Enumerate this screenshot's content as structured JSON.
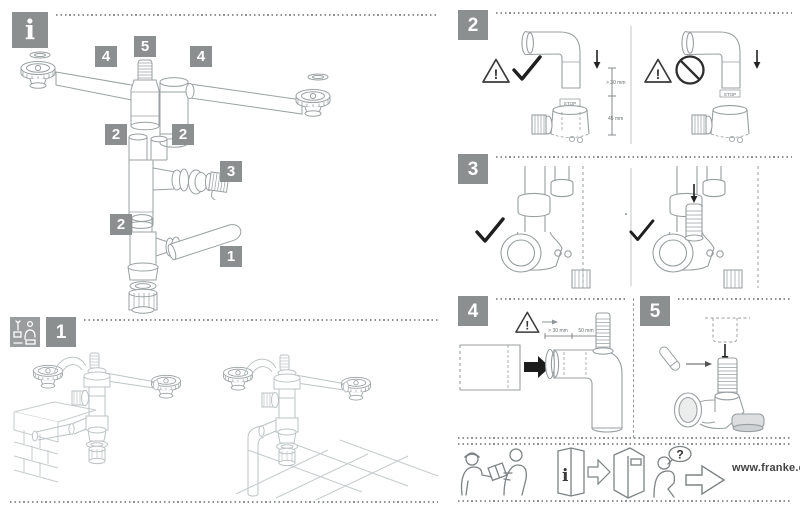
{
  "info_panel": {
    "icon": "i",
    "part_labels": [
      "4",
      "5",
      "4",
      "2",
      "2",
      "3",
      "2",
      "1"
    ]
  },
  "steps": [
    {
      "number": "1"
    },
    {
      "number": "2",
      "dim_upper": "> 30 mm",
      "dim_lower": "45 mm",
      "stop_marking": "STOP"
    },
    {
      "number": "3"
    },
    {
      "number": "4",
      "dim_insertion": "> 30 mm",
      "dim_free": "50 mm"
    },
    {
      "number": "5"
    }
  ],
  "footer": {
    "booklet_icon_label": "i",
    "question_label": "?",
    "website": "www.franke.com"
  },
  "colors": {
    "badge_bg": "#8c8f90",
    "line_art": "#9aa0a2",
    "line_art_light": "#bdc3c5",
    "symbol_dark": "#2b2b2b",
    "dot_line": "#8f9294",
    "page_bg": "#ffffff"
  }
}
